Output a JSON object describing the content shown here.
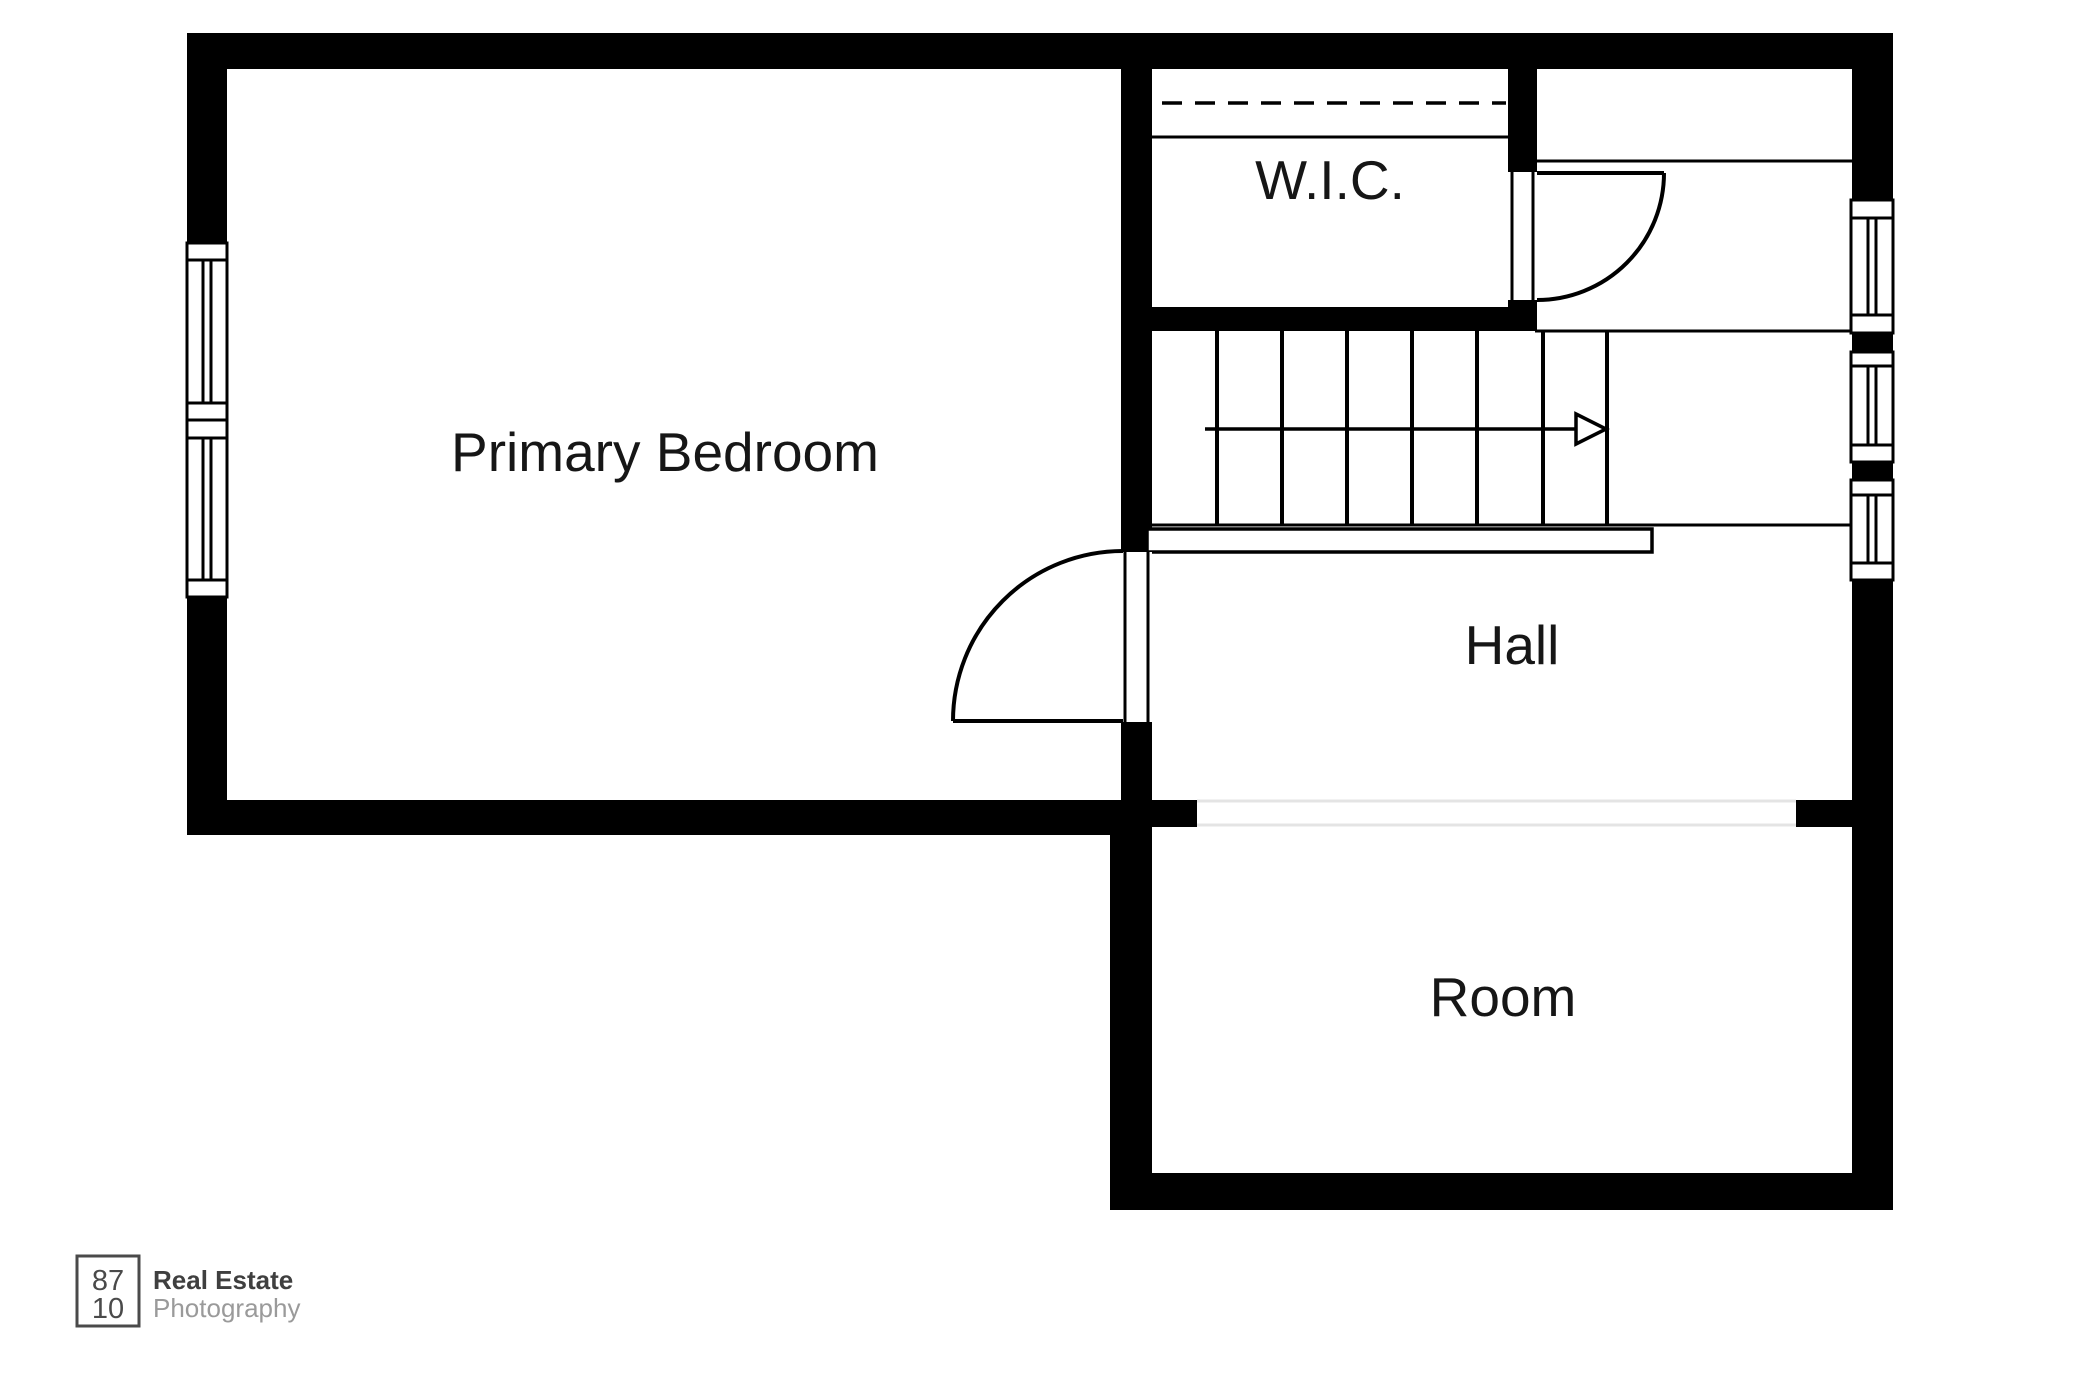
{
  "plan": {
    "type": "floor-plan",
    "rooms": [
      {
        "id": "primary-bedroom",
        "label": "Primary Bedroom"
      },
      {
        "id": "wic",
        "label": "W.I.C."
      },
      {
        "id": "hall",
        "label": "Hall"
      },
      {
        "id": "room",
        "label": "Room"
      }
    ],
    "features": {
      "stairs": {
        "treads": 7,
        "direction_arrow": "right"
      },
      "doors": [
        "primary-bedroom-door",
        "closet-room-door"
      ],
      "windows": [
        "left-wall-double-window",
        "right-wall-window-1",
        "right-wall-window-2",
        "right-wall-window-3"
      ],
      "wic_rod": "dashed-closet-rod",
      "wall_opening": "hall-to-room-opening"
    },
    "colors": {
      "wall": "#000000",
      "background": "#ffffff",
      "opening_line": "#e4e4e4",
      "label_text": "#161616"
    }
  },
  "logo": {
    "box_line1": "87",
    "box_line2": "10",
    "brand_line1": "Real Estate",
    "brand_line2": "Photography",
    "brand_color": "#3f3f3f",
    "secondary_color": "#9a9a9a"
  }
}
